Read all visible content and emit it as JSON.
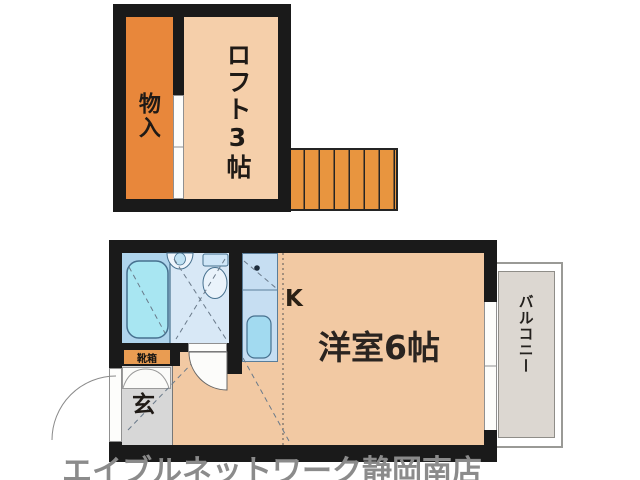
{
  "floorplan": {
    "loft_section": {
      "storage_label": "物入",
      "loft_label": "ロフト3帖"
    },
    "main_section": {
      "kitchen_label": "K",
      "room_label": "洋室6帖",
      "entrance_label": "玄",
      "shoebox_label": "靴箱",
      "balcony_label": "バルコニー"
    }
  },
  "watermark": {
    "text": "エイブルネットワーク静岡南店"
  },
  "colors": {
    "wall": "#1a1a1a",
    "storage_orange": "#e8873b",
    "loft_peach": "#f5cfaa",
    "stairs_orange": "#e8953f",
    "room_peach": "#f2c9a3",
    "bathtub_area_blue": "#afd4ec",
    "bathtub_cyan": "#a8e6f2",
    "toilet_area_blue": "#d8e8f6",
    "kitchen_blue": "#c6def2",
    "entrance_gray": "#d7d7d7",
    "balcony_gray": "#dcd7d1",
    "watermark_gray": "#8b8b8b"
  }
}
